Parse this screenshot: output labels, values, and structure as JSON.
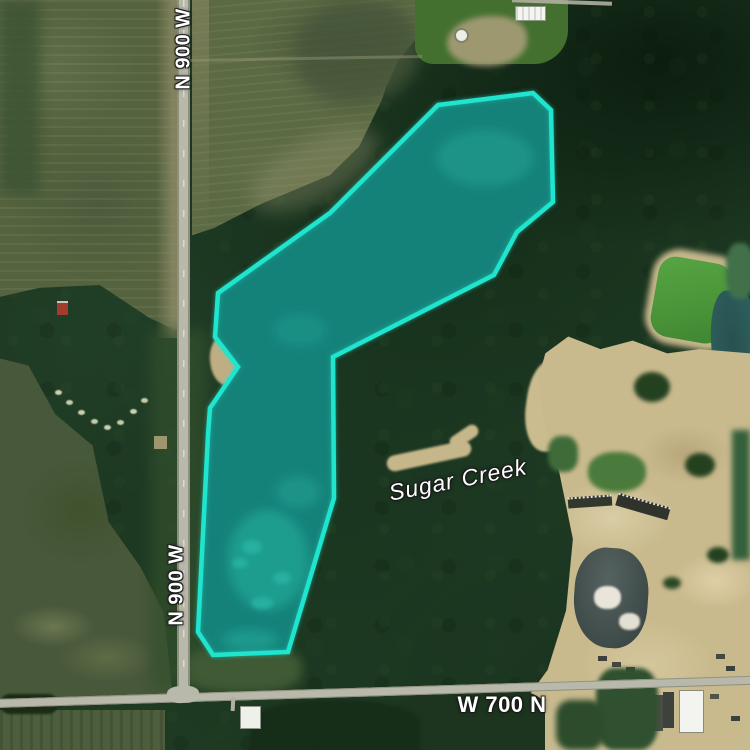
{
  "map": {
    "type": "satellite-imagery",
    "labels": {
      "road_vertical_top": "N 900 W",
      "road_vertical_bottom": "N 900 W",
      "road_horizontal": "W 700 N",
      "waterway": "Sugar Creek"
    },
    "parcel": {
      "points": "438,105 533,93 551,110 553,202 517,232 494,275 333,357 334,498 288,652 213,655 198,632 208,435 210,408 238,367 215,337 218,293 330,213",
      "stroke_color": "#1fe5ce",
      "fill_color": "rgba(34,230,207,0.30)"
    },
    "colors": {
      "forest": "#1e3a23",
      "field": "#55633e",
      "sand": "#c9ba8e",
      "road": "#b8b8ab",
      "water_dark": "#0e3d3d",
      "pond_green": "#54a041",
      "label_text": "#ffffff"
    }
  }
}
